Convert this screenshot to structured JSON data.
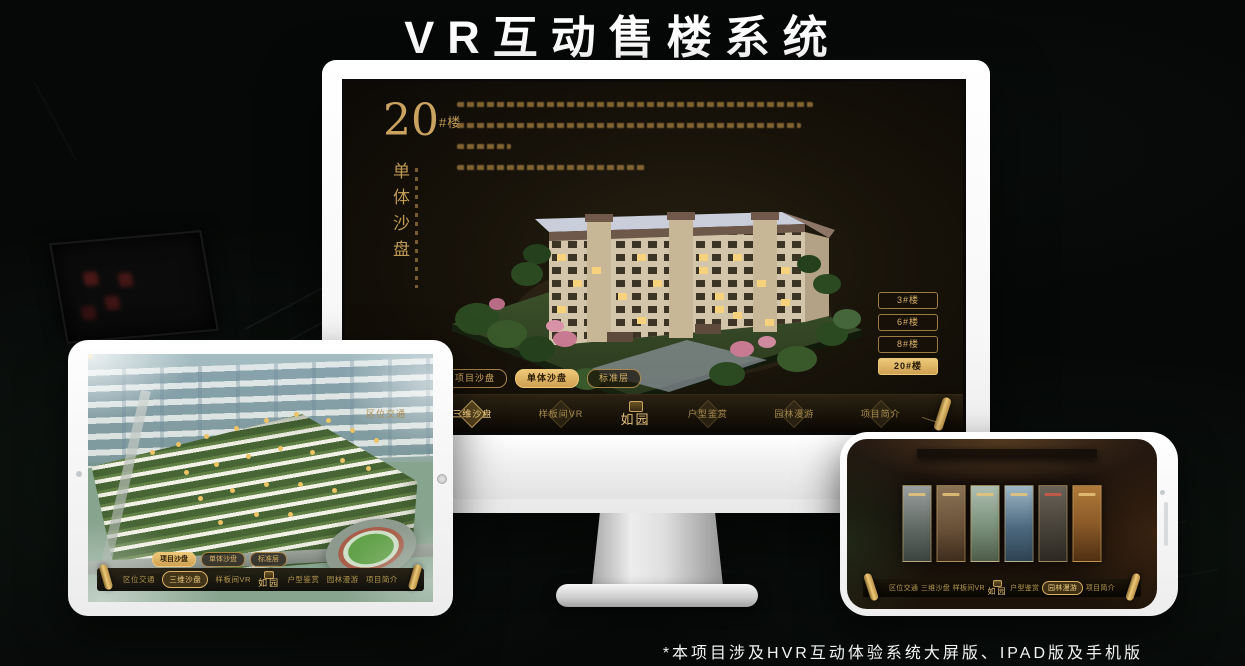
{
  "title": "VR互动售楼系统",
  "footnote": "*本项目涉及HVR互动体验系统大屏版、IPAD版及手机版",
  "logo": "如园",
  "colors": {
    "gold": "#c9a35f",
    "gold_bright": "#ecc57c",
    "active_fill": "#d9b36a",
    "screen_bg": "#171209"
  },
  "monitor": {
    "floor_number": "20",
    "floor_suffix": "#楼",
    "vertical_title": "单体沙盘",
    "floor_buttons": [
      {
        "label": "3#楼",
        "active": false
      },
      {
        "label": "6#楼",
        "active": false
      },
      {
        "label": "8#楼",
        "active": false
      },
      {
        "label": "20#楼",
        "active": true
      }
    ],
    "tabs": [
      {
        "label": "项目沙盘",
        "active": false
      },
      {
        "label": "单体沙盘",
        "active": true
      },
      {
        "label": "标准层",
        "active": false
      }
    ],
    "nav": [
      {
        "label": "区位交通",
        "active": false
      },
      {
        "label": "三维沙盘",
        "active": true
      },
      {
        "label": "样板间VR",
        "active": false
      },
      {
        "label": "户型鉴赏",
        "active": false
      },
      {
        "label": "园林漫游",
        "active": false
      },
      {
        "label": "项目简介",
        "active": false
      }
    ]
  },
  "tablet": {
    "tabs": [
      {
        "label": "项目沙盘",
        "active": true
      },
      {
        "label": "单体沙盘",
        "active": false
      },
      {
        "label": "标准层",
        "active": false
      }
    ],
    "nav": [
      {
        "label": "区位交通",
        "active": false
      },
      {
        "label": "三维沙盘",
        "active": true
      },
      {
        "label": "样板间VR",
        "active": false
      },
      {
        "label": "户型鉴赏",
        "active": false
      },
      {
        "label": "园林漫游",
        "active": false
      },
      {
        "label": "项目简介",
        "active": false
      }
    ]
  },
  "phone": {
    "nav": [
      {
        "label": "区位交通",
        "active": false
      },
      {
        "label": "三维沙盘",
        "active": false
      },
      {
        "label": "样板间VR",
        "active": false
      },
      {
        "label": "户型鉴赏",
        "active": false
      },
      {
        "label": "园林漫游",
        "active": true
      },
      {
        "label": "项目简介",
        "active": false
      }
    ]
  }
}
